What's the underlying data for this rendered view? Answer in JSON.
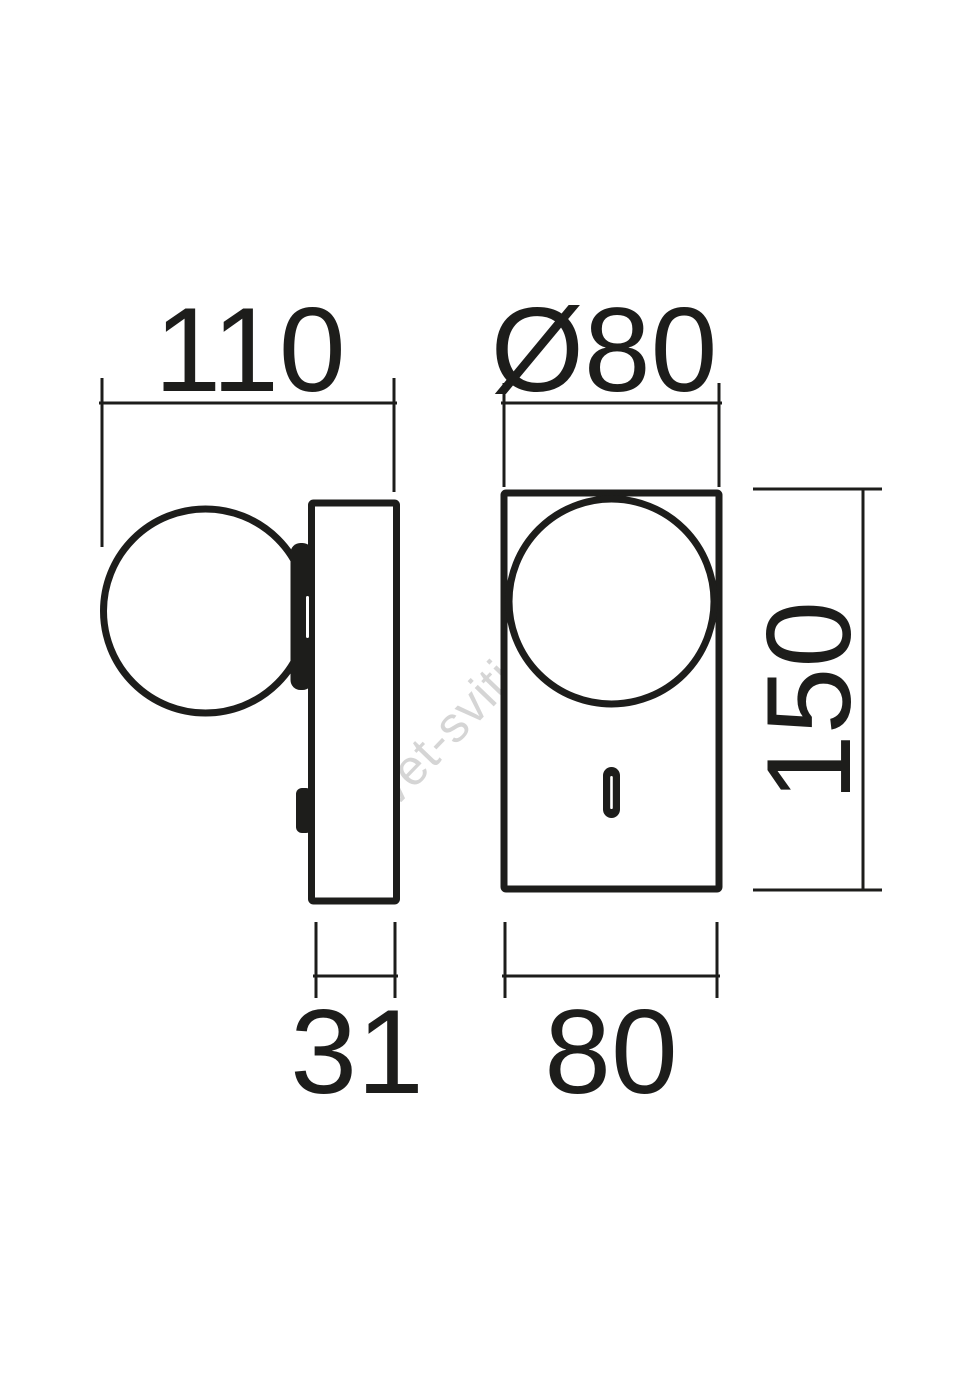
{
  "colors": {
    "ink": "#1d1d1b",
    "wm": "#d5d5d5",
    "bg": "#ffffff"
  },
  "watermark": {
    "text": "svet-svitidel.cz"
  },
  "drawing": {
    "type": "technical-dimension-drawing",
    "dimensions": [
      {
        "id": "overall-depth",
        "label": "110"
      },
      {
        "id": "sphere-diameter",
        "label": "Ø80"
      },
      {
        "id": "body-height",
        "label": "150"
      },
      {
        "id": "plate-depth",
        "label": "31"
      },
      {
        "id": "body-width",
        "label": "80"
      }
    ]
  }
}
